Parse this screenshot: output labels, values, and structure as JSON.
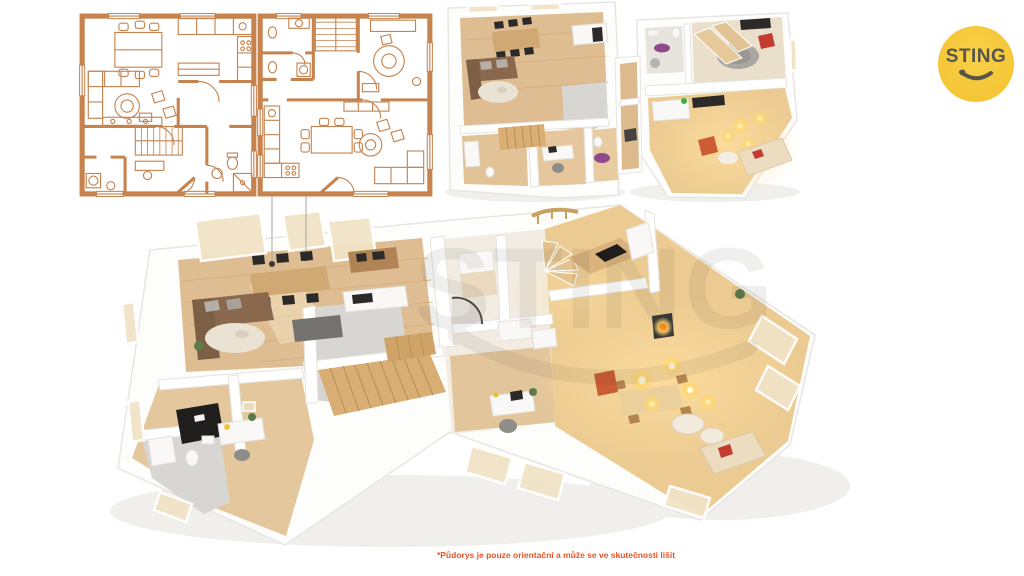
{
  "canvas": {
    "width": 1024,
    "height": 576,
    "background": "#ffffff"
  },
  "logo": {
    "text": "STING"
  },
  "watermark": {
    "text": "STING"
  },
  "disclaimer": {
    "text": "*Půdorys je pouze orientační a může se ve skutečnosti lišit"
  },
  "colors": {
    "logo_bg": "#F5C535",
    "logo_text": "#56564B",
    "disclaimer": "#E65427",
    "watermark": "#45423B",
    "plan_line": "#C6834E",
    "wall_stroke": "#E5E3DE",
    "wood_light": "#DFBD92",
    "wood_warm": "#ECCB92",
    "stair_wood": "#D9AE74",
    "counter_wood": "#CFA873",
    "tile_gray": "#D8D6D2",
    "dark": "#2B2A28",
    "sofa_brown": "#8A684E",
    "rug_beige": "#EAE3D4",
    "accent_red": "#C23B31",
    "accent_orange": "#CC5C32",
    "accent_purple": "#8E4A8A",
    "glow": "#FFD76E"
  }
}
